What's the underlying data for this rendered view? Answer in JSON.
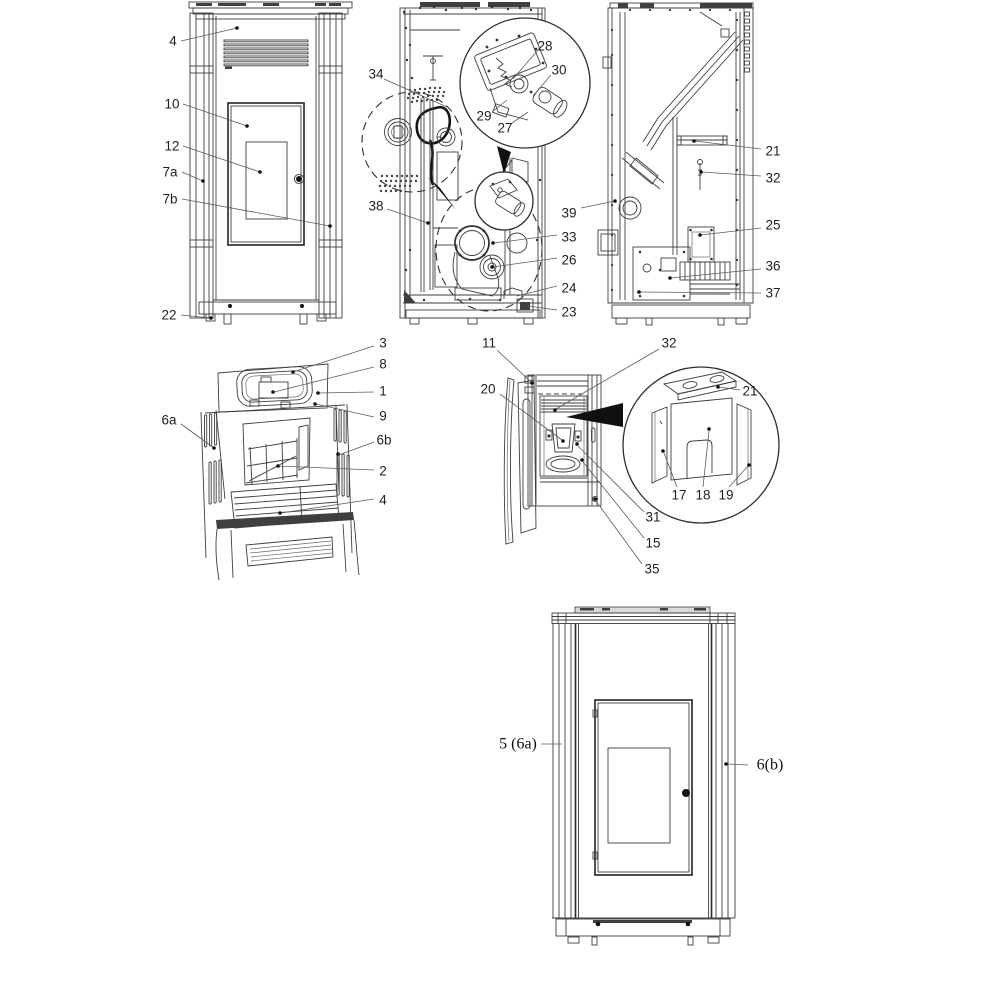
{
  "figure": {
    "type": "exploded-parts-diagram",
    "background": "#ffffff",
    "line_color": "#3e3e3e",
    "views": [
      {
        "id": "front-view",
        "label_font": "sans",
        "labels": [
          {
            "text": "4",
            "x": 173,
            "y": 41,
            "leader": [
              [
                181,
                41
              ],
              [
                237,
                28
              ]
            ],
            "dot": [
              237,
              28
            ]
          },
          {
            "text": "10",
            "x": 172,
            "y": 104,
            "leader": [
              [
                183,
                104
              ],
              [
                247,
                126
              ]
            ],
            "dot": [
              247,
              126
            ]
          },
          {
            "text": "12",
            "x": 172,
            "y": 146,
            "leader": [
              [
                183,
                146
              ],
              [
                260,
                172
              ]
            ],
            "dot": [
              260,
              172
            ]
          },
          {
            "text": "7a",
            "x": 170,
            "y": 172,
            "leader": [
              [
                182,
                172
              ],
              [
                203,
                181
              ]
            ],
            "dot": [
              203,
              181
            ]
          },
          {
            "text": "7b",
            "x": 170,
            "y": 199,
            "leader": [
              [
                182,
                199
              ],
              [
                330,
                226
              ]
            ],
            "dot": [
              330,
              226
            ]
          },
          {
            "text": "22",
            "x": 169,
            "y": 315,
            "leader": [
              [
                181,
                315
              ],
              [
                211,
                318
              ]
            ],
            "dot": [
              211,
              318
            ]
          }
        ]
      },
      {
        "id": "rear-section-view",
        "label_font": "sans",
        "labels": [
          {
            "text": "34",
            "x": 376,
            "y": 74,
            "leader": [
              [
                384,
                79
              ],
              [
                447,
                107
              ]
            ]
          },
          {
            "text": "38",
            "x": 376,
            "y": 206,
            "leader": [
              [
                387,
                209
              ],
              [
                428,
                223
              ]
            ],
            "dot": [
              428,
              223
            ]
          },
          {
            "text": "28",
            "x": 545,
            "y": 46,
            "leader": [
              [
                538,
                50
              ],
              [
                513,
                79
              ]
            ]
          },
          {
            "text": "30",
            "x": 559,
            "y": 70,
            "leader": [
              [
                551,
                75
              ],
              [
                533,
                96
              ]
            ]
          },
          {
            "text": "29",
            "x": 484,
            "y": 116,
            "leader": [
              [
                492,
                112
              ],
              [
                507,
                100
              ]
            ]
          },
          {
            "text": "27",
            "x": 505,
            "y": 128,
            "leader": [
              [
                512,
                123
              ],
              [
                528,
                112
              ]
            ]
          },
          {
            "text": "39",
            "x": 569,
            "y": 213,
            "leader": [
              [
                581,
                208
              ],
              [
                615,
                201
              ]
            ],
            "dot": [
              615,
              201
            ]
          },
          {
            "text": "33",
            "x": 569,
            "y": 237,
            "leader": [
              [
                557,
                235
              ],
              [
                494,
                243
              ]
            ],
            "dot": [
              493,
              243
            ]
          },
          {
            "text": "26",
            "x": 569,
            "y": 260,
            "leader": [
              [
                557,
                258
              ],
              [
                493,
                267
              ]
            ],
            "dot": [
              492,
              267
            ]
          },
          {
            "text": "24",
            "x": 569,
            "y": 288,
            "leader": [
              [
                557,
                286
              ],
              [
                517,
                296
              ]
            ]
          },
          {
            "text": "23",
            "x": 569,
            "y": 312,
            "leader": [
              [
                557,
                310
              ],
              [
                528,
                306
              ]
            ]
          }
        ]
      },
      {
        "id": "side-section-view",
        "label_font": "sans",
        "labels": [
          {
            "text": "21",
            "x": 773,
            "y": 151,
            "leader": [
              [
                761,
                149
              ],
              [
                695,
                141
              ]
            ],
            "dot": [
              694,
              141
            ]
          },
          {
            "text": "32",
            "x": 773,
            "y": 178,
            "leader": [
              [
                761,
                176
              ],
              [
                702,
                172
              ]
            ],
            "dot": [
              701,
              172
            ]
          },
          {
            "text": "25",
            "x": 773,
            "y": 225,
            "leader": [
              [
                761,
                228
              ],
              [
                701,
                235
              ]
            ],
            "dot": [
              700,
              235
            ]
          },
          {
            "text": "36",
            "x": 773,
            "y": 266,
            "leader": [
              [
                761,
                269
              ],
              [
                671,
                278
              ]
            ],
            "dot": [
              670,
              278
            ]
          },
          {
            "text": "37",
            "x": 773,
            "y": 293,
            "leader": [
              [
                761,
                293
              ],
              [
                640,
                292
              ]
            ],
            "dot": [
              639,
              292
            ]
          }
        ]
      },
      {
        "id": "top-view",
        "label_font": "sans",
        "labels": [
          {
            "text": "3",
            "x": 383,
            "y": 343,
            "leader": [
              [
                374,
                346
              ],
              [
                293,
                372
              ]
            ],
            "dot": [
              293,
              372
            ]
          },
          {
            "text": "8",
            "x": 383,
            "y": 364,
            "leader": [
              [
                374,
                367
              ],
              [
                274,
                392
              ]
            ],
            "dot": [
              273,
              392
            ]
          },
          {
            "text": "1",
            "x": 383,
            "y": 391,
            "leader": [
              [
                374,
                392
              ],
              [
                319,
                393
              ]
            ],
            "dot": [
              318,
              393
            ]
          },
          {
            "text": "9",
            "x": 383,
            "y": 416,
            "leader": [
              [
                374,
                417
              ],
              [
                316,
                404
              ]
            ],
            "dot": [
              315,
              404
            ]
          },
          {
            "text": "6b",
            "x": 384,
            "y": 440,
            "leader": [
              [
                374,
                442
              ],
              [
                339,
                455
              ]
            ],
            "dot": [
              338,
              454
            ]
          },
          {
            "text": "2",
            "x": 383,
            "y": 471,
            "leader": [
              [
                374,
                470
              ],
              [
                278,
                466
              ],
              [
                254,
                478
              ]
            ],
            "dot": [
              278,
              466
            ]
          },
          {
            "text": "4",
            "x": 383,
            "y": 500,
            "leader": [
              [
                374,
                499
              ],
              [
                281,
                513
              ]
            ],
            "dot": [
              280,
              513
            ]
          },
          {
            "text": "6a",
            "x": 169,
            "y": 420,
            "leader": [
              [
                181,
                424
              ],
              [
                214,
                448
              ]
            ],
            "dot": [
              214,
              448
            ]
          }
        ]
      },
      {
        "id": "open-door-view",
        "label_font": "sans",
        "labels": [
          {
            "text": "11",
            "x": 489,
            "y": 343,
            "leader": [
              [
                497,
                350
              ],
              [
                531,
                382
              ]
            ],
            "dot": [
              532,
              383
            ]
          },
          {
            "text": "32",
            "x": 669,
            "y": 343,
            "leader": [
              [
                659,
                349
              ],
              [
                556,
                409
              ]
            ],
            "dot": [
              555,
              410
            ]
          },
          {
            "text": "20",
            "x": 488,
            "y": 389,
            "leader": [
              [
                500,
                394
              ],
              [
                562,
                440
              ]
            ],
            "dot": [
              563,
              441
            ]
          },
          {
            "text": "21",
            "x": 750,
            "y": 391,
            "leader": [
              [
                740,
                390
              ],
              [
                719,
                387
              ]
            ],
            "dot": [
              718,
              387
            ]
          },
          {
            "text": "17",
            "x": 679,
            "y": 495,
            "leader": [
              [
                677,
                487
              ],
              [
                664,
                453
              ]
            ],
            "dot": [
              663,
              451
            ]
          },
          {
            "text": "18",
            "x": 703,
            "y": 495,
            "leader": [
              [
                703,
                487
              ],
              [
                709,
                431
              ]
            ],
            "dot": [
              709,
              429
            ]
          },
          {
            "text": "19",
            "x": 726,
            "y": 495,
            "leader": [
              [
                729,
                487
              ],
              [
                748,
                466
              ]
            ],
            "dot": [
              749,
              465
            ]
          },
          {
            "text": "31",
            "x": 653,
            "y": 517,
            "leader": [
              [
                644,
                512
              ],
              [
                578,
                446
              ]
            ],
            "dot": [
              577,
              444
            ]
          },
          {
            "text": "15",
            "x": 653,
            "y": 543,
            "leader": [
              [
                644,
                538
              ],
              [
                583,
                462
              ]
            ],
            "dot": [
              582,
              460
            ]
          },
          {
            "text": "35",
            "x": 652,
            "y": 569,
            "leader": [
              [
                642,
                564
              ],
              [
                596,
                501
              ]
            ],
            "dot": [
              595,
              499
            ]
          }
        ]
      },
      {
        "id": "side-panel-view",
        "label_font": "serif",
        "labels": [
          {
            "text": "5 (6a)",
            "x": 518,
            "y": 744,
            "leader": [
              [
                541,
                744
              ],
              [
                562,
                744
              ]
            ]
          },
          {
            "text": "6(b)",
            "x": 770,
            "y": 765,
            "leader": [
              [
                748,
                765
              ],
              [
                727,
                764
              ]
            ],
            "dot": [
              726,
              764
            ]
          }
        ]
      }
    ]
  }
}
